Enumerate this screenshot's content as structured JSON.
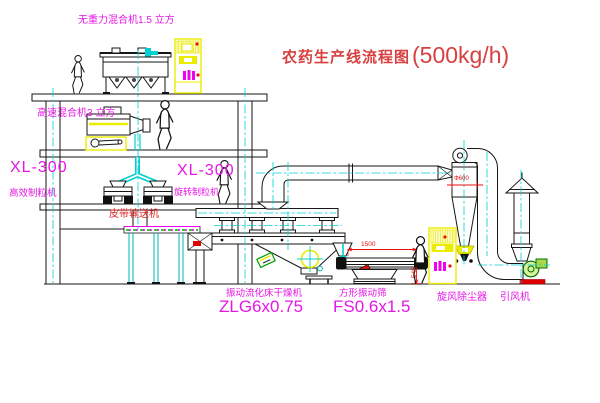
{
  "title": {
    "zh": "农药生产线流程图",
    "capacity": "(500kg/h)"
  },
  "equipment_labels": {
    "gravity_free_mixer": "无重力混合机1.5 立方",
    "high_speed_mixer": "高速混合机3 立方",
    "granulator_left_model": "XL-300",
    "granulator_left_name": "高效制粒机",
    "granulator_right_model": "XL-300",
    "granulator_right_name": "旋转制粒机",
    "belt_conveyor": "皮带输送机",
    "dryer_name": "振动流化床干燥机",
    "dryer_model": "ZLG6x0.75",
    "sieve_name": "方形振动筛",
    "sieve_model": "FS0.6x1.5",
    "cyclone": "旋风除尘器",
    "fan": "引风机"
  },
  "dimensions": {
    "sieve_length": "1500",
    "sieve_height": "545",
    "cyclone_dia": "Φ600"
  },
  "colors": {
    "label_magenta": "#e616e6",
    "title_red": "#d84040",
    "dimension_red": "#e81010",
    "centerline_cyan": "#00cfcf",
    "cabinet_yellow": "#ecec00",
    "line_black": "#161616"
  }
}
